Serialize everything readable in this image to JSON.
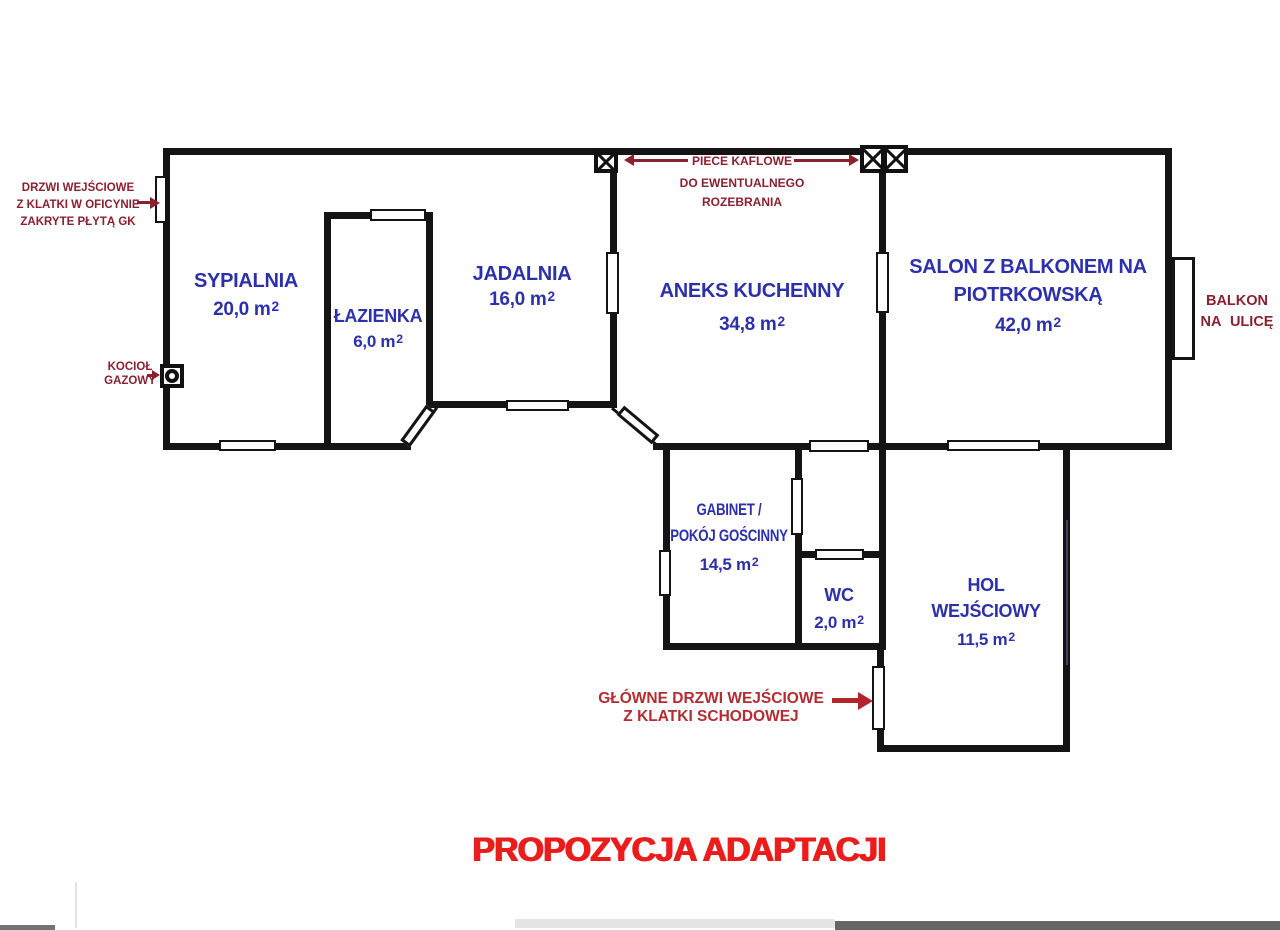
{
  "title": "PROPOZYCJA ADAPTACJI",
  "rooms": {
    "sypialnia": {
      "name": "SYPIALNIA",
      "area": "20,0 m",
      "sup": "2"
    },
    "lazienka": {
      "name": "ŁAZIENKA",
      "area": "6,0 m",
      "sup": "2"
    },
    "jadalnia": {
      "name": "JADALNIA",
      "area": "16,0 m",
      "sup": "2"
    },
    "aneks_kuchenny": {
      "name": "ANEKS KUCHENNY",
      "area": "34,8 m",
      "sup": "2"
    },
    "salon": {
      "name_line1": "SALON Z BALKONEM NA",
      "name_line2": "PIOTRKOWSKĄ",
      "area": "42,0 m",
      "sup": "2"
    },
    "gabinet": {
      "name_line1": "GABINET /",
      "name_line2": "POKÓJ GOŚCINNY",
      "area": "14,5 m",
      "sup": "2"
    },
    "wc": {
      "name": "WC",
      "area": "2,0 m",
      "sup": "2"
    },
    "hol": {
      "name_line1": "HOL",
      "name_line2": "WEJŚCIOWY",
      "area": "11,5 m",
      "sup": "2"
    }
  },
  "annotations": {
    "entry_door": {
      "line1": "DRZWI WEJŚCIOWE",
      "line2": "Z KLATKI W OFICYNIE",
      "line3": "ZAKRYTE PŁYTĄ GK"
    },
    "boiler": {
      "line1": "KOCIOŁ",
      "line2": "GAZOWY"
    },
    "stoves": {
      "line1": "PIECE KAFLOWE",
      "line2": "DO EWENTUALNEGO",
      "line3": "ROZEBRANIA"
    },
    "balcony": {
      "line1": "BALKON",
      "line2": "NA ULICĘ"
    },
    "main_door": {
      "line1": "GŁÓWNE DRZWI WEJŚCIOWE",
      "line2": "Z KLATKI SCHODOWEJ"
    }
  },
  "colors": {
    "wall": "#141414",
    "room_label": "#2c31ab",
    "annotation": "#8b2031",
    "main_door_text": "#b22c31",
    "entrance_arrow": "#b5242a",
    "title": "#ea1c1c"
  }
}
